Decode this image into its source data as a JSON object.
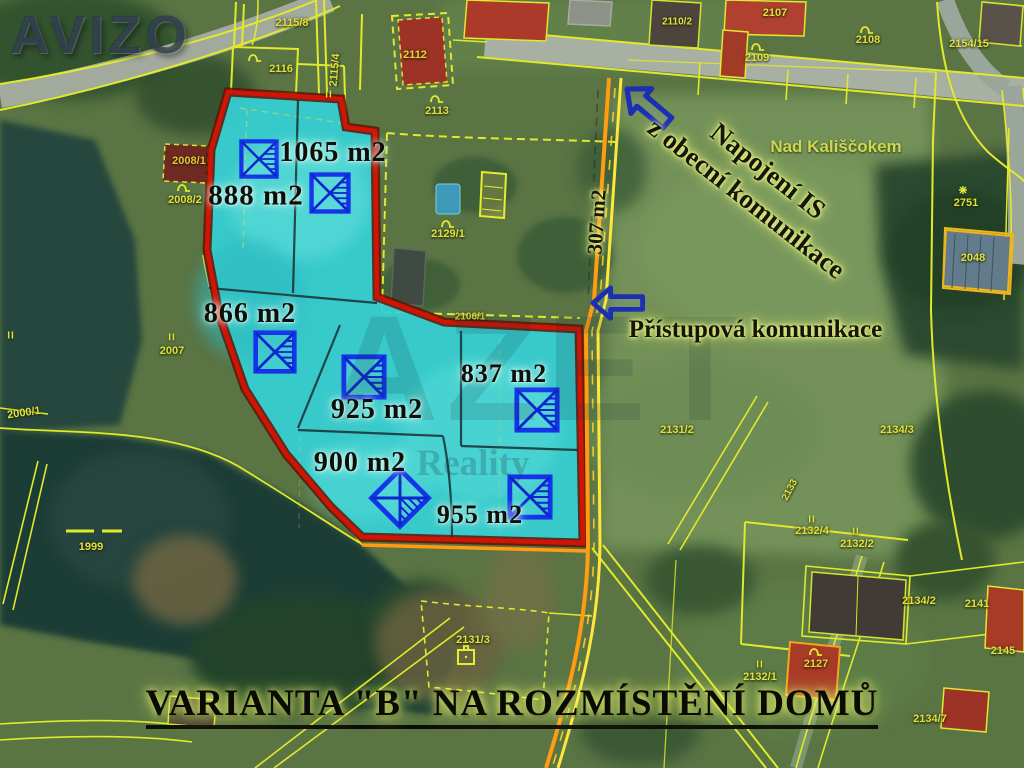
{
  "branding": {
    "avizo_watermark": "AVIZO",
    "azet_watermark": "AZET",
    "azet_watermark_sub": "Reality"
  },
  "title": "VARIANTA \"B\" NA ROZMÍSTĚNÍ DOMŮ",
  "annotations": {
    "utility_connection_line1": "Napojení IS",
    "utility_connection_line2": "z obecní komunikace",
    "access_road": "Přístupová komunikace",
    "road_area": "307 m2",
    "place_name": "Nad Kališčokem"
  },
  "plots": [
    {
      "area": "888 m2"
    },
    {
      "area": "1065 m2"
    },
    {
      "area": "866 m2"
    },
    {
      "area": "925 m2"
    },
    {
      "area": "837 m2"
    },
    {
      "area": "900 m2"
    },
    {
      "area": "955 m2"
    }
  ],
  "parcels": [
    {
      "number": "2115/8"
    },
    {
      "number": "2116"
    },
    {
      "number": "2115/4"
    },
    {
      "number": "2112"
    },
    {
      "number": "2113"
    },
    {
      "number": "2110/2"
    },
    {
      "number": "2107"
    },
    {
      "number": "2109"
    },
    {
      "number": "2108"
    },
    {
      "number": "2154/15"
    },
    {
      "number": "2751"
    },
    {
      "number": "2048"
    },
    {
      "number": "2008/1"
    },
    {
      "number": "2008/2"
    },
    {
      "number": "2007"
    },
    {
      "number": "2000/1"
    },
    {
      "number": "1999"
    },
    {
      "number": "2129/1"
    },
    {
      "number": "2106/1"
    },
    {
      "number": "2131/2"
    },
    {
      "number": "2134/3"
    },
    {
      "number": "2132/4"
    },
    {
      "number": "2132/2"
    },
    {
      "number": "2134/2"
    },
    {
      "number": "2141"
    },
    {
      "number": "2132/1"
    },
    {
      "number": "2127"
    },
    {
      "number": "2145"
    },
    {
      "number": "2134/7"
    },
    {
      "number": "2131/3"
    },
    {
      "number": "2133"
    }
  ],
  "icons": {
    "meadow_mark": "II"
  },
  "colors": {
    "plot_highlight": "#35d0d6",
    "plot_outline_red": "#d31404",
    "house_symbol_blue": "#1633e8",
    "cadastral_yellow": "#e0e92c",
    "road_highlight_orange": "#ff9c10",
    "arrow_blue": "#1b2fb2"
  }
}
